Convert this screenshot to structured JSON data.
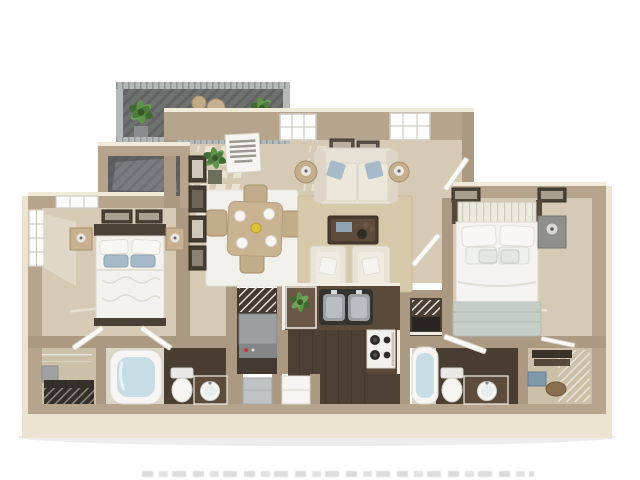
{
  "scene": {
    "kind": "3d-floor-plan-rendering",
    "view": "top-down dollhouse",
    "unit_type": "2 bedroom / 2 bathroom apartment with balcony"
  },
  "rooms": [
    "Balcony",
    "Patio storage",
    "Living room",
    "Dining area",
    "Kitchen",
    "Laundry / pantry nook",
    "Linen closet",
    "Bedroom 1",
    "Bedroom 2",
    "Bathroom 1",
    "Bathroom 2",
    "Walk-in closet 1",
    "Walk-in closet 2",
    "Hallway"
  ],
  "furnishings": {
    "balcony": [
      "potted plant",
      "potted plant",
      "bistro table",
      "two bistro chairs",
      "slatted railing"
    ],
    "living_room": [
      "sofa with blue accent pillows",
      "two framed pictures",
      "two windows",
      "two side tables with lamps",
      "sisal area rug",
      "coffee table with decor",
      "two accent chairs with pillows",
      "floor plant",
      "leaning wall sign (text illegible)",
      "column of framed art",
      "open door"
    ],
    "dining_area": [
      "dining table",
      "four chairs",
      "four white place settings",
      "yellow centerpiece",
      "white area rug"
    ],
    "kitchen": [
      "L-shaped dark wood counter with white trim",
      "stainless double sink",
      "white range with burners",
      "counter plant",
      "white refrigerator"
    ],
    "laundry_nook": [
      "wire shelving",
      "gray washer unit with red indicator",
      "gray appliance"
    ],
    "bedroom_1": [
      "bed with patterned white duvet",
      "blue accent pillows",
      "dark headboard",
      "two nightstands with lamps",
      "two framed pictures",
      "side window",
      "top window",
      "open door"
    ],
    "bedroom_2": [
      "bed with white linens and sage throw",
      "white slatted headboard",
      "gray nightstand with lamp",
      "two framed pictures",
      "open door"
    ],
    "bathroom_1": [
      "bathtub",
      "toilet",
      "dark vanity with round vessel sink",
      "open door"
    ],
    "bathroom_2": [
      "bathtub",
      "toilet",
      "dark vanity with round vessel sink",
      "open door"
    ],
    "closet_1": [
      "wire shelving",
      "hanging clothes",
      "gray storage box"
    ],
    "closet_2": [
      "wire shelving",
      "stacked shelf storage",
      "blue tote",
      "basket"
    ]
  },
  "wall_sign": {
    "legible": false
  },
  "footer": {
    "disclaimer_text_cropped": true
  },
  "palette": {
    "wall": "#b6a58c",
    "wallInner": "#ab9a81",
    "wallFace": "#ece3d1",
    "wallTrim": "#f1ead9",
    "carpet": "#d7cab4",
    "carpetDim": "#cdc0a9",
    "rugWhite": "#f2f0ea",
    "rugSisal": "#d8c9ab",
    "woodDark": "#4c3f34",
    "counter": "#5b4a3a",
    "counterEnd": "#6b5847",
    "whiteFix": "#f6f5f2",
    "steel": "#9ba1a3",
    "balconyFloor": "#6f7170",
    "railing": "#b5b9ba",
    "slate": "#5f6162",
    "water": "#c7dde6",
    "sage": "#c6cfc7",
    "bluePillow": "#a6bac9",
    "tanWood": "#c7b190",
    "appliance": "#9b9fa0",
    "clothes": "#35302a",
    "plantDark": "#3f6a31",
    "plantLight": "#6da257"
  }
}
